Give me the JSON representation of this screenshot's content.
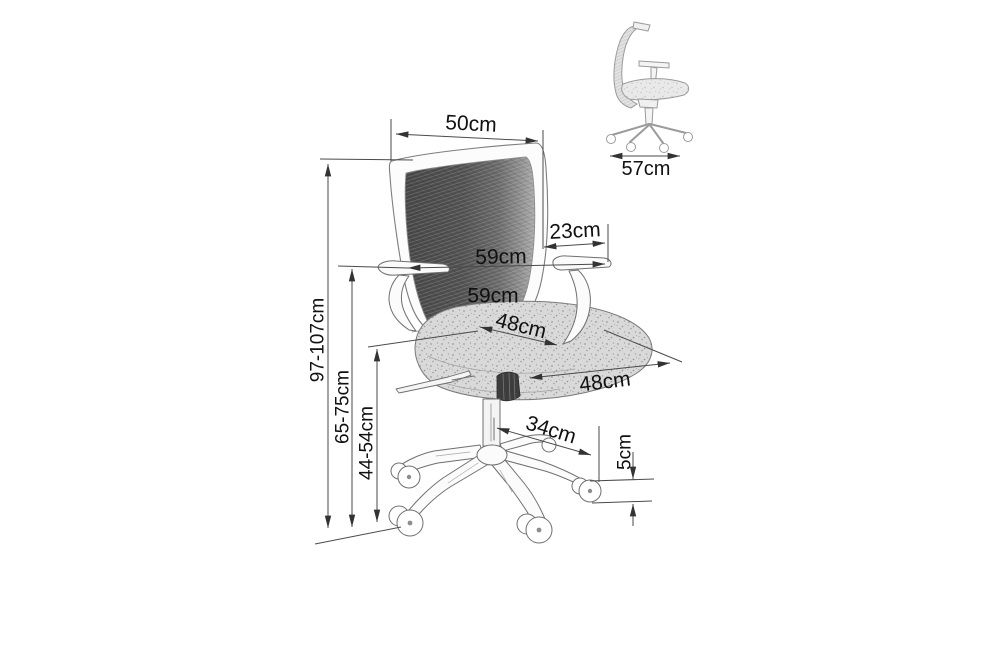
{
  "background": "#ffffff",
  "style": {
    "line_color": "#4a4a4a",
    "text_color": "#111111",
    "mesh_color": "#555555",
    "seat_color": "#d9d9d9",
    "arrow_color": "#333333"
  },
  "diagram": {
    "kind": "office chair dimension drawing",
    "unit": "cm",
    "main_view": {
      "dimensions": [
        {
          "id": "backrest-width",
          "label": "50cm",
          "value": 50
        },
        {
          "id": "armrest-pad-depth",
          "label": "23cm",
          "value": 23
        },
        {
          "id": "armrest-span",
          "label": "59cm",
          "value": 59
        },
        {
          "id": "overall-width",
          "label": "59cm",
          "value": 59
        },
        {
          "id": "seat-width",
          "label": "48cm",
          "value": 48
        },
        {
          "id": "seat-depth",
          "label": "48cm",
          "value": 48
        },
        {
          "id": "base-leg-radius",
          "label": "34cm",
          "value": 34
        },
        {
          "id": "caster-height",
          "label": "5cm",
          "value": 5
        },
        {
          "id": "overall-height",
          "label": "97-107cm",
          "min": 97,
          "max": 107
        },
        {
          "id": "armrest-height",
          "label": "65-75cm",
          "min": 65,
          "max": 75
        },
        {
          "id": "seat-height",
          "label": "44-54cm",
          "min": 44,
          "max": 54
        }
      ]
    },
    "side_view": {
      "dimensions": [
        {
          "id": "overall-depth",
          "label": "57cm",
          "value": 57
        }
      ]
    }
  }
}
